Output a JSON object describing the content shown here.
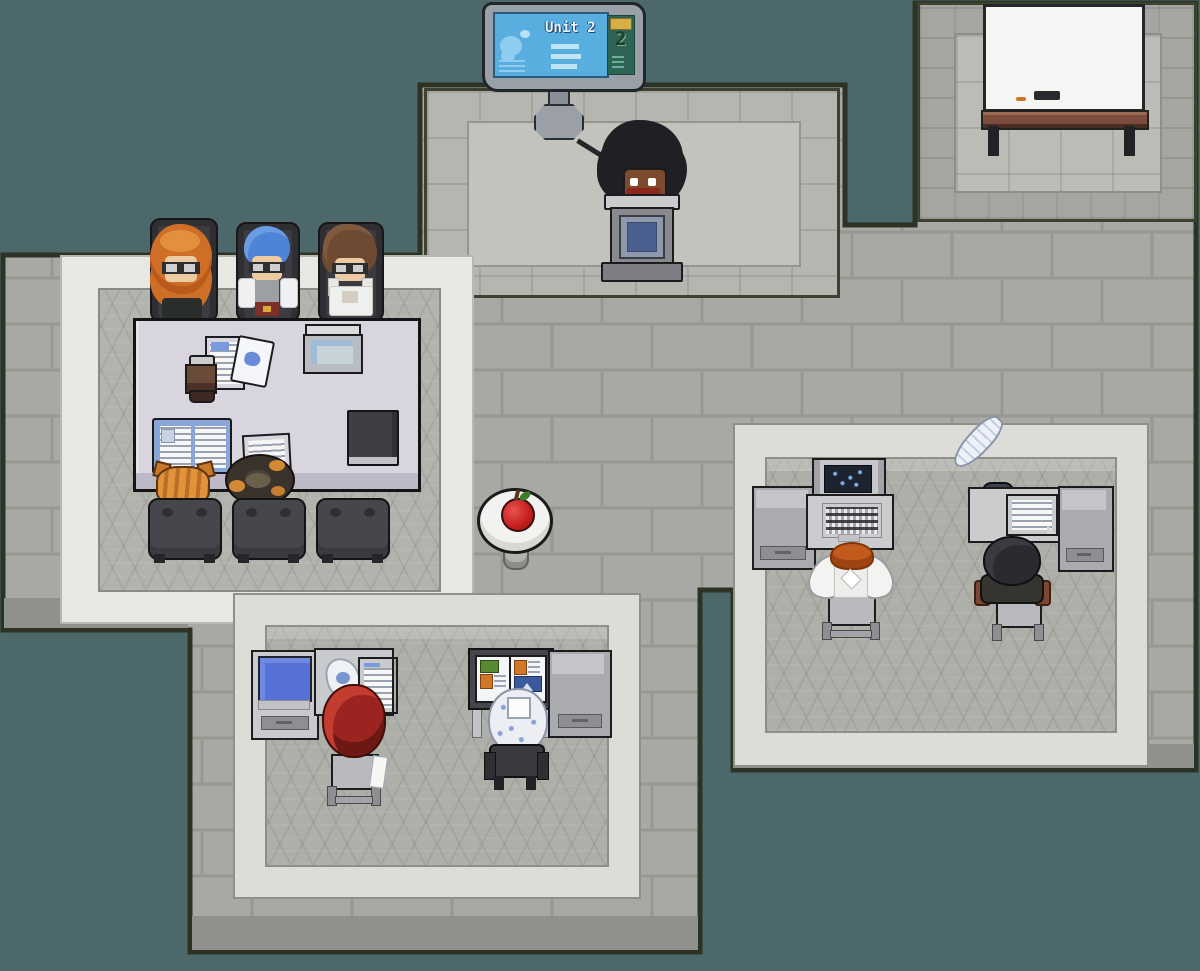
{
  "sign": {
    "title": "Unit 2",
    "badge": "2"
  },
  "colors": {
    "background": "#4d686b",
    "plaza_floor": "#a8a9a4",
    "room_floor": "#aeafa9",
    "room_wall_band": "#dcdcd9",
    "meeting_room_band": "#e7e7e4",
    "building_outline": "#2d3324",
    "table_top": "#d9d5de",
    "sign_screen": "#58aede",
    "sign_badge_plate": "#d8ae4a",
    "whiteboard": "#f5f5f3",
    "monitor_screen": "#5672d8",
    "apple": "#c42020"
  },
  "rooms": [
    {
      "name": "lecture-room",
      "objects": [
        "unit-sign",
        "podium"
      ],
      "occupants": [
        "instructor-dark-afro"
      ]
    },
    {
      "name": "whiteboard-room",
      "objects": [
        "whiteboard",
        "eraser",
        "marker"
      ],
      "occupants": []
    },
    {
      "name": "meeting-room",
      "objects": [
        "conference-table",
        "laptop",
        "coffee-cup",
        "document",
        "memo-sheet",
        "open-book",
        "note-paper",
        "dark-notebook",
        "office-chairs"
      ],
      "occupants": [
        "student-orange-curly-hair",
        "student-blue-hair",
        "student-brown-hair",
        "cat-orange-tabby",
        "cat-calico-curled"
      ]
    },
    {
      "name": "east-office",
      "objects": [
        "computer-desk",
        "computer-monitor",
        "keyboard",
        "quill-pen",
        "ink-pot",
        "letter-paper",
        "writing-desk"
      ],
      "occupants": [
        "worker-angel-wings-orange-hair",
        "worker-dark-hooded"
      ]
    },
    {
      "name": "south-office",
      "objects": [
        "monitor-desk",
        "blue-monitor",
        "scrap-paper",
        "report-sheet",
        "picture-book",
        "reading-desk"
      ],
      "occupants": [
        "worker-big-red-hair",
        "worker-white-blue-curly-hair"
      ]
    },
    {
      "name": "hallway",
      "objects": [
        "round-side-table",
        "apple"
      ],
      "occupants": []
    }
  ],
  "characters": [
    {
      "name": "instructor-dark-afro",
      "hair": "#202024",
      "location": "lecture-room-podium"
    },
    {
      "name": "student-orange-curly-hair",
      "hair": "#cf6e26",
      "location": "meeting-table"
    },
    {
      "name": "student-blue-hair",
      "hair": "#4d84d6",
      "location": "meeting-table"
    },
    {
      "name": "student-brown-hair",
      "hair": "#6d4a31",
      "location": "meeting-table"
    },
    {
      "name": "cat-orange-tabby",
      "fur": "#e29238",
      "location": "meeting-table-edge"
    },
    {
      "name": "cat-calico-curled",
      "fur": "#3a332c",
      "location": "meeting-table-edge"
    },
    {
      "name": "worker-angel-wings-orange-hair",
      "hair": "#c35a1d",
      "location": "east-office-computer-desk"
    },
    {
      "name": "worker-dark-hooded",
      "hair": "#2b2b2f",
      "location": "east-office-writing-desk"
    },
    {
      "name": "worker-big-red-hair",
      "hair": "#9c2420",
      "location": "south-office-monitor-desk"
    },
    {
      "name": "worker-white-blue-curly-hair",
      "hair": "#eceef4",
      "location": "south-office-reading-desk"
    }
  ]
}
